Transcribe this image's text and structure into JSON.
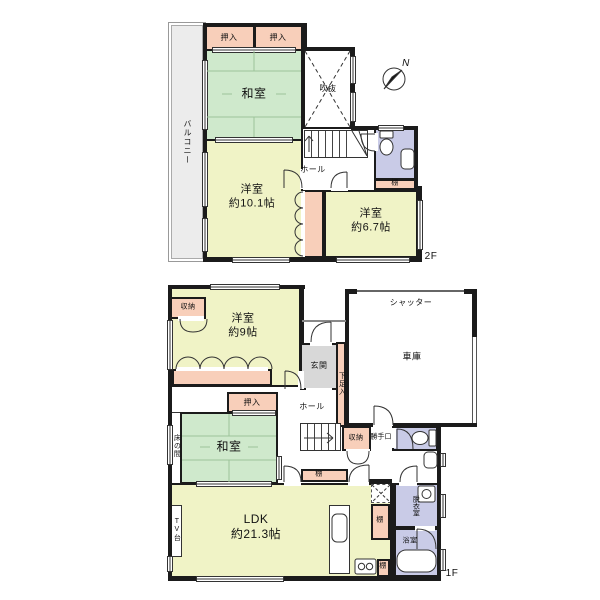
{
  "compass": {
    "north_label": "N"
  },
  "colors": {
    "wall": "#1b1b1b",
    "tatami": "#cfe9cc",
    "western": "#f0f3c6",
    "closet": "#f8cfba",
    "wet": "#c9cbe7",
    "entrance": "#d8d8d8",
    "balcony": "#ececec"
  },
  "floor2": {
    "floor_label": "2F",
    "balcony": "バルコニー",
    "oshiire_left": "押入",
    "oshiire_right": "押入",
    "washitsu": "和室",
    "void": "吹抜",
    "hall": "ホール",
    "shelf": "棚",
    "western_room_large": {
      "name": "洋室",
      "area": "約10.1帖"
    },
    "western_room_small": {
      "name": "洋室",
      "area": "約6.7帖"
    }
  },
  "floor1": {
    "floor_label": "1F",
    "storage_nw": "収納",
    "western_room": {
      "name": "洋室",
      "area": "約9帖"
    },
    "shutter": "シャッター",
    "garage": "車庫",
    "entrance": "玄関",
    "shoe_cabinet": "下足入",
    "oshiire": "押入",
    "hall": "ホール",
    "tokonoma": "床の間",
    "washitsu": "和室",
    "storage_mid": "収納",
    "back_door": "勝手口",
    "shelf_hall": "棚",
    "ldk": {
      "name": "LDK",
      "area": "約21.3帖"
    },
    "tv_stand": "TV台",
    "shelf_kitchen": "棚",
    "dressing_room": "脱衣室",
    "bathroom": "浴室",
    "shelf_bottom": "棚"
  }
}
